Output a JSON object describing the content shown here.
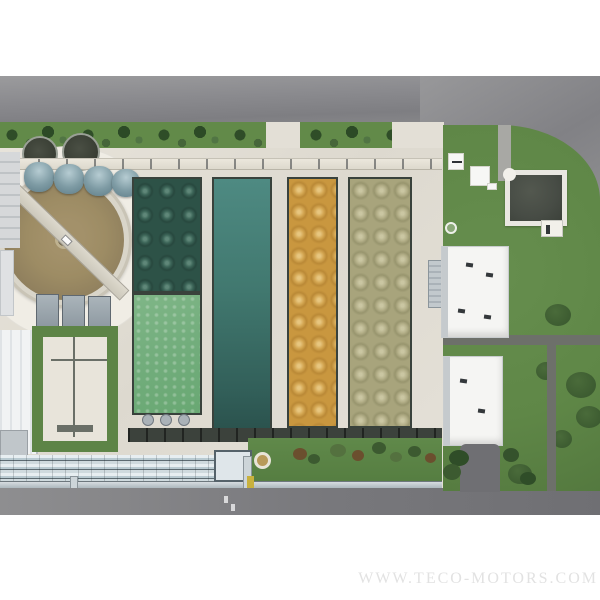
{
  "image_type": "aerial-photograph",
  "subject": "wastewater-treatment-plant-top-view",
  "watermark": {
    "text": "WWW.TECO-MOTORS.COM"
  },
  "palette": {
    "page-bg": "#ffffff",
    "road": "#8a8a8e",
    "concrete": "#e3dfd6",
    "concrete-bright": "#f0ede5",
    "grass": "#5f8747",
    "grass-dark": "#3d5c31",
    "tree": "#2f4d28",
    "basin1-dark": "#2d5247",
    "basin1-light": "#72ad7c",
    "basin2-teal": "#41786f",
    "basin3-gold": "#c9973f",
    "basin4-olive": "#a8a47c",
    "clarifier-water": "#9d8c64",
    "dome-tank": "#7e9ba4",
    "dark-tank": "#383d33",
    "pool-dark": "#474c45",
    "building-white": "#f5f5f3",
    "pipe-rack": "#cfdade",
    "channel-dark": "#3c423c",
    "turf": "#5d8446",
    "yellow-equipment": "#c8b13e"
  },
  "regions": {
    "clarifier": "circular clarifier tank with rotating bridge",
    "dome_tanks": "four dome-roof digester tanks",
    "dark_tanks": "two open circular tanks",
    "basin1": "aeration basin dark green with bubble diffusers, light green lower section",
    "basin2": "teal sedimentation basin",
    "basin3": "gold aeration basin with bubble diffusers",
    "basin4": "olive aeration basin with bubble diffusers",
    "square_pool": "dark square holding pool",
    "buildings": "two white service buildings, left edge buildings",
    "pipe_rack": "horizontal pipe gallery",
    "roads": "top road, bottom road, right corner road"
  }
}
